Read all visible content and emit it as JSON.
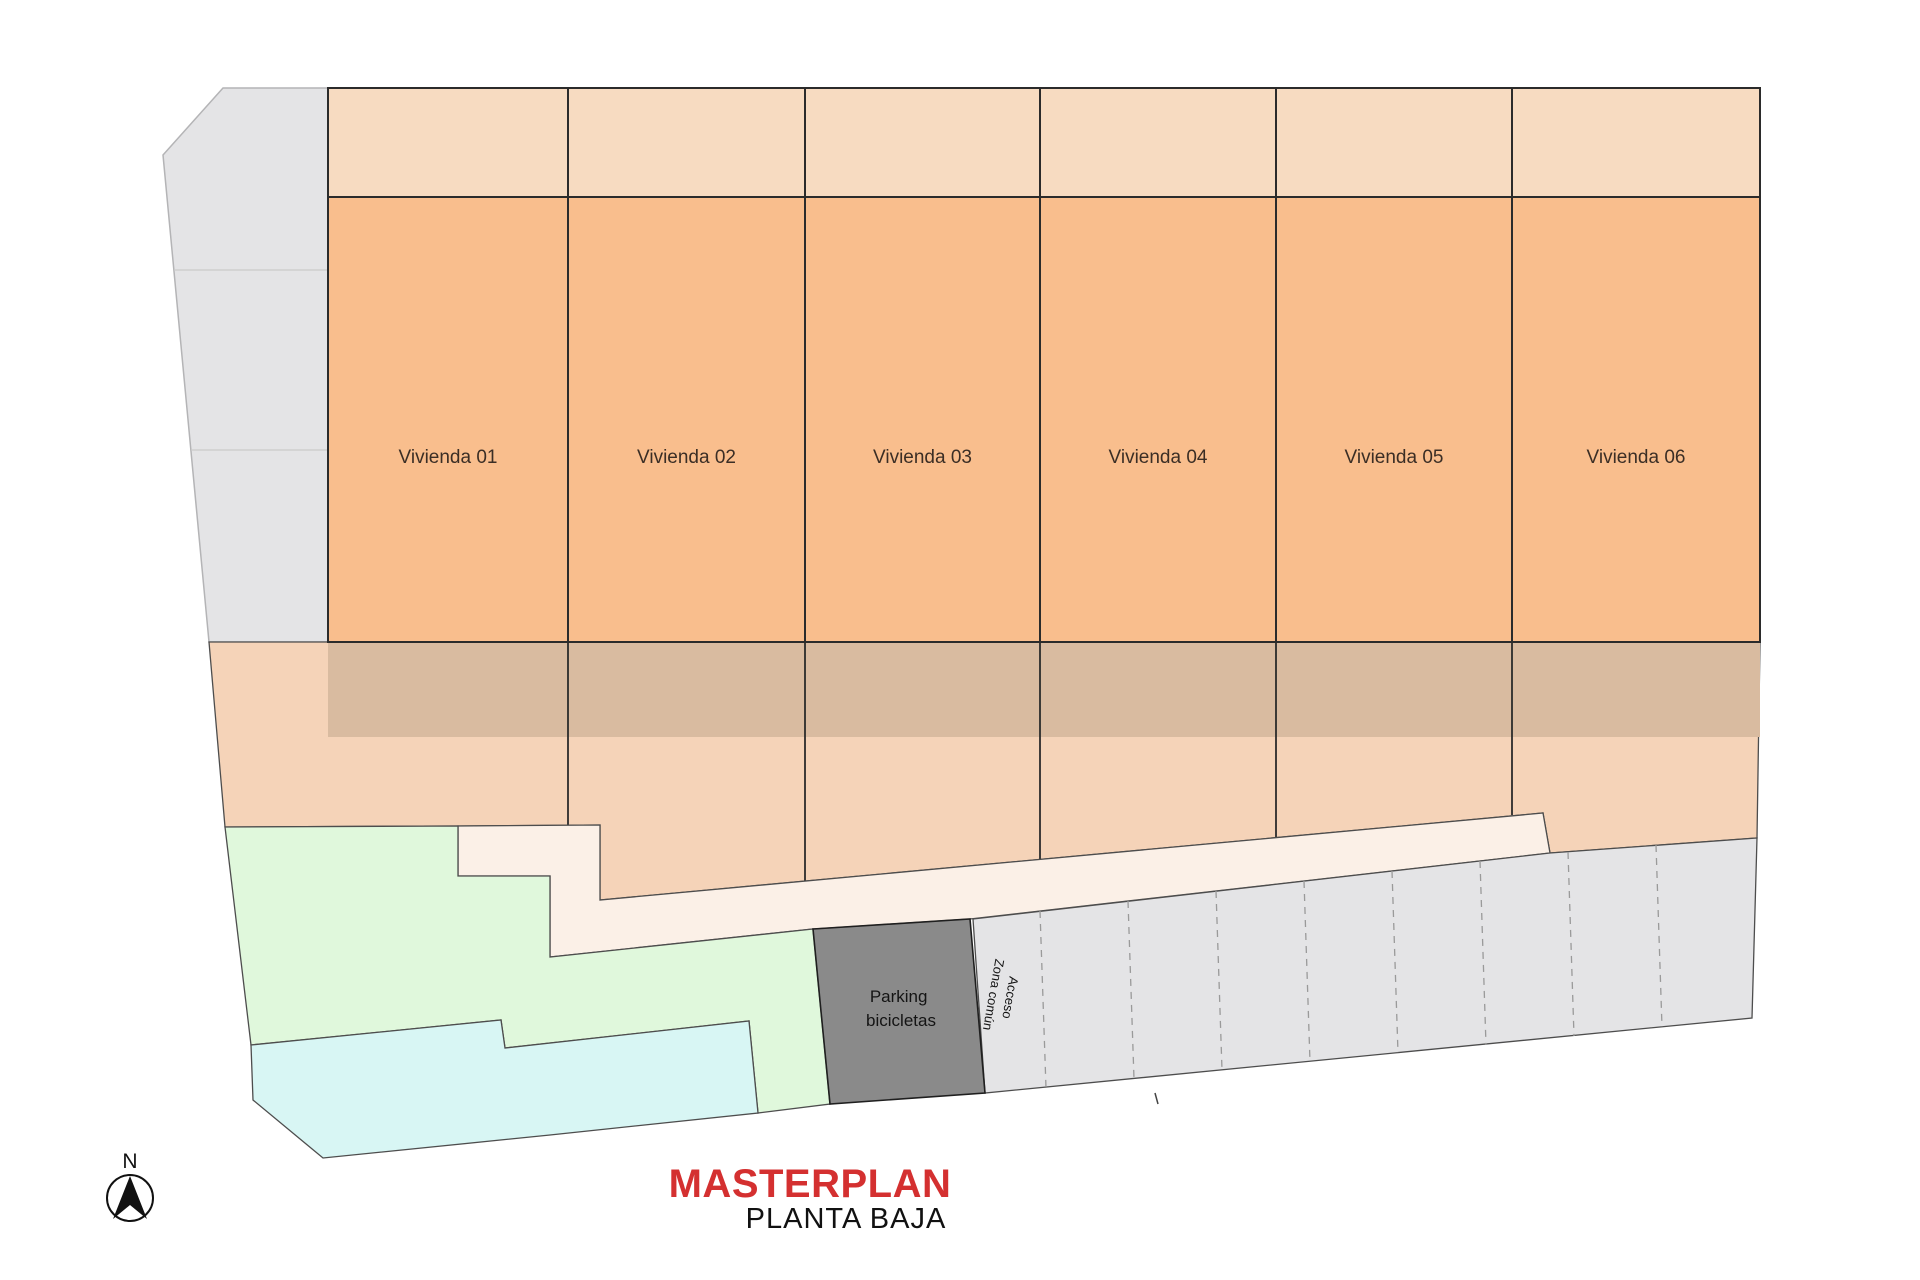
{
  "title": {
    "main": "MASTERPLAN",
    "sub": "PLANTA BAJA"
  },
  "units": {
    "labels": [
      "Vivienda 01",
      "Vivienda 02",
      "Vivienda 03",
      "Vivienda 04",
      "Vivienda 05",
      "Vivienda 06"
    ]
  },
  "parking_box": {
    "line1": "Parking",
    "line2": "bicicletas"
  },
  "access": {
    "line1": "Acceso",
    "line2": "Zona común"
  },
  "compass": {
    "label": "N"
  },
  "colors": {
    "unit_fill": "#F9BE8D",
    "roof_strip_fill": "#F7DBC1",
    "patio_band_fill": "#D9BBA0",
    "garden_plot_fill": "#F5D3B8",
    "walkway_fill": "#FBF0E7",
    "green_fill": "#E0F8DC",
    "pool_fill": "#D8F6F4",
    "gray_fill": "#E4E4E6",
    "parking_fill": "#E4E4E6",
    "bike_box_fill": "#8A8A8A",
    "title_red": "#D43030",
    "ink": "#1F1F1F"
  }
}
